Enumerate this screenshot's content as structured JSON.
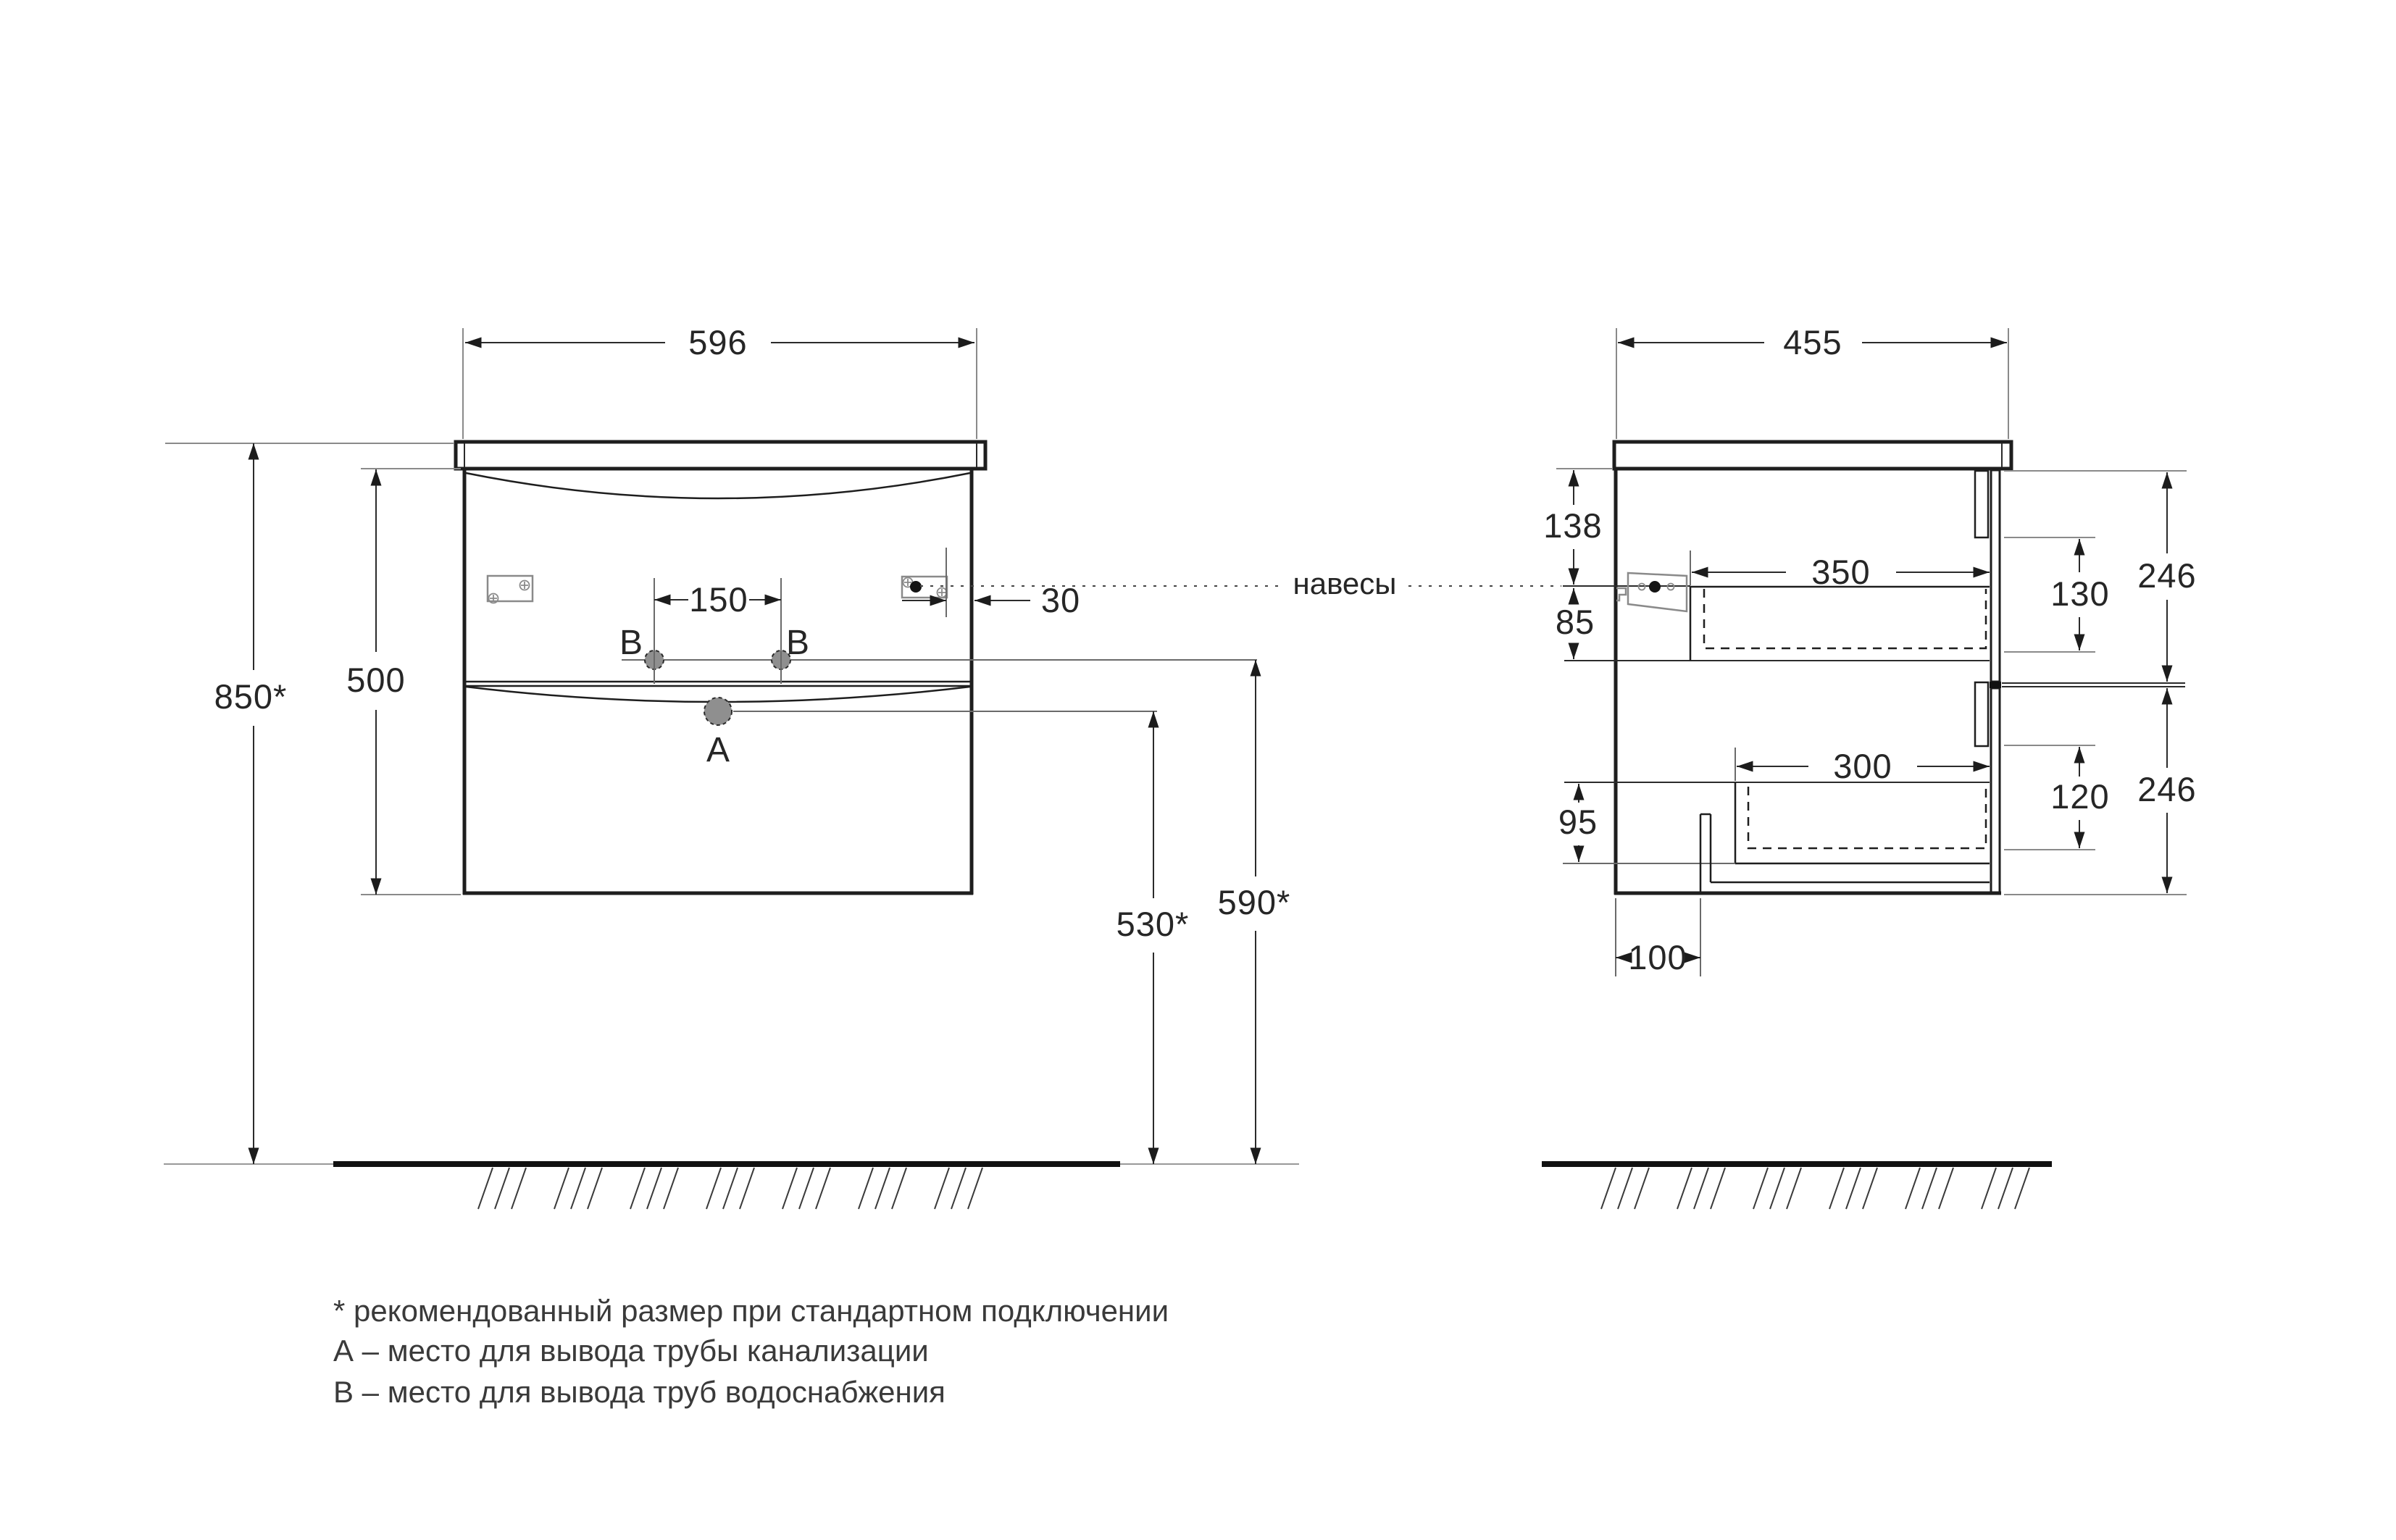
{
  "views": {
    "front": {
      "dims": {
        "width": "596",
        "body_height": "500",
        "install_height": "850*",
        "hole_spacing": "150",
        "hinge_offset": "30",
        "drain_outlet_height": "530*",
        "water_outlet_height": "590*"
      },
      "points": {
        "a": "A",
        "b_left": "B",
        "b_right": "B"
      }
    },
    "side": {
      "dims": {
        "depth": "455",
        "top_to_hanger": "138",
        "hanger_to_drawer": "85",
        "upper_drawer_depth": "350",
        "upper_drawer_inner_height": "130",
        "upper_front_height": "246",
        "lower_drawer_depth": "300",
        "lower_drawer_inner_height": "120",
        "lower_front_height": "246",
        "lower_drawer_to_bottom": "95",
        "pipe_cutout_width": "100"
      }
    },
    "hangers_label": "навесы"
  },
  "legend": {
    "note": "* рекомендованный размер при стандартном подключении",
    "point_a": "А – место для вывода трубы канализации",
    "point_b": "В – место для вывода труб водоснабжения"
  },
  "colors": {
    "line": "#1e1e1e",
    "thin": "#8a8a8a",
    "hole_fill": "#8f8f8f",
    "text": "#262626"
  }
}
